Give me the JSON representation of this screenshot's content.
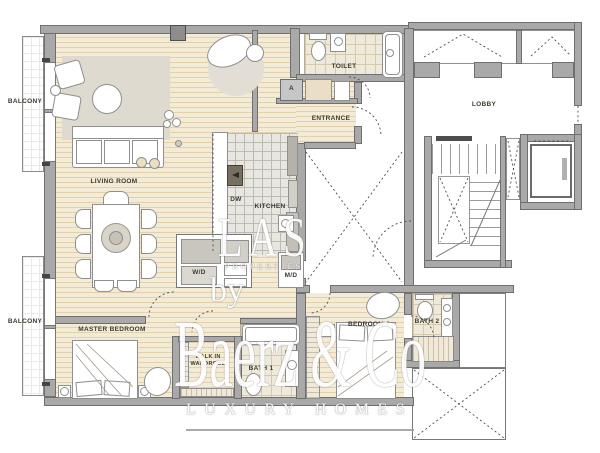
{
  "canvas": {
    "width": 600,
    "height": 453,
    "background": "#ffffff"
  },
  "palette": {
    "wall": "#a9a9a9",
    "wall_outline": "#6f6f6f",
    "wood_floor": "#f4ebd7",
    "wood_plank_line": "#e2d1ad",
    "tile_floor": "#efe9da",
    "kitchen_tile": "#e8e6e1",
    "furniture_stroke": "#8f8f8f",
    "label_text": "#3d3b31",
    "watermark": "#ffffff"
  },
  "rooms": {
    "balcony_upper": {
      "label": "BALCONY"
    },
    "balcony_lower": {
      "label": "BALCONY"
    },
    "living_room": {
      "label": "LIVING ROOM"
    },
    "entrance": {
      "label": "ENTRANCE"
    },
    "toilet": {
      "label": "TOILET"
    },
    "closet_a": {
      "label": "A"
    },
    "kitchen": {
      "label": "KITCHEN"
    },
    "dishwasher": {
      "label": "DW"
    },
    "washer_dryer": {
      "label": "W/D"
    },
    "md_unit": {
      "label": "M/D"
    },
    "lobby": {
      "label": "LOBBY"
    },
    "master_bedroom": {
      "label": "MASTER BEDROOM"
    },
    "walk_in_wardrobe": {
      "line1": "WALK IN",
      "line2": "WARDROBE"
    },
    "bath_1": {
      "label": "BATH 1"
    },
    "bedroom_2": {
      "label": "BEDROOM 2"
    },
    "bath_2": {
      "label": "BATH 2"
    }
  },
  "watermark": {
    "monogram": "LAS",
    "monogram_sub": "PROPERTIES",
    "connector": "by",
    "brand": "Baerz & Co",
    "tagline": "LUXURY HOMES"
  }
}
